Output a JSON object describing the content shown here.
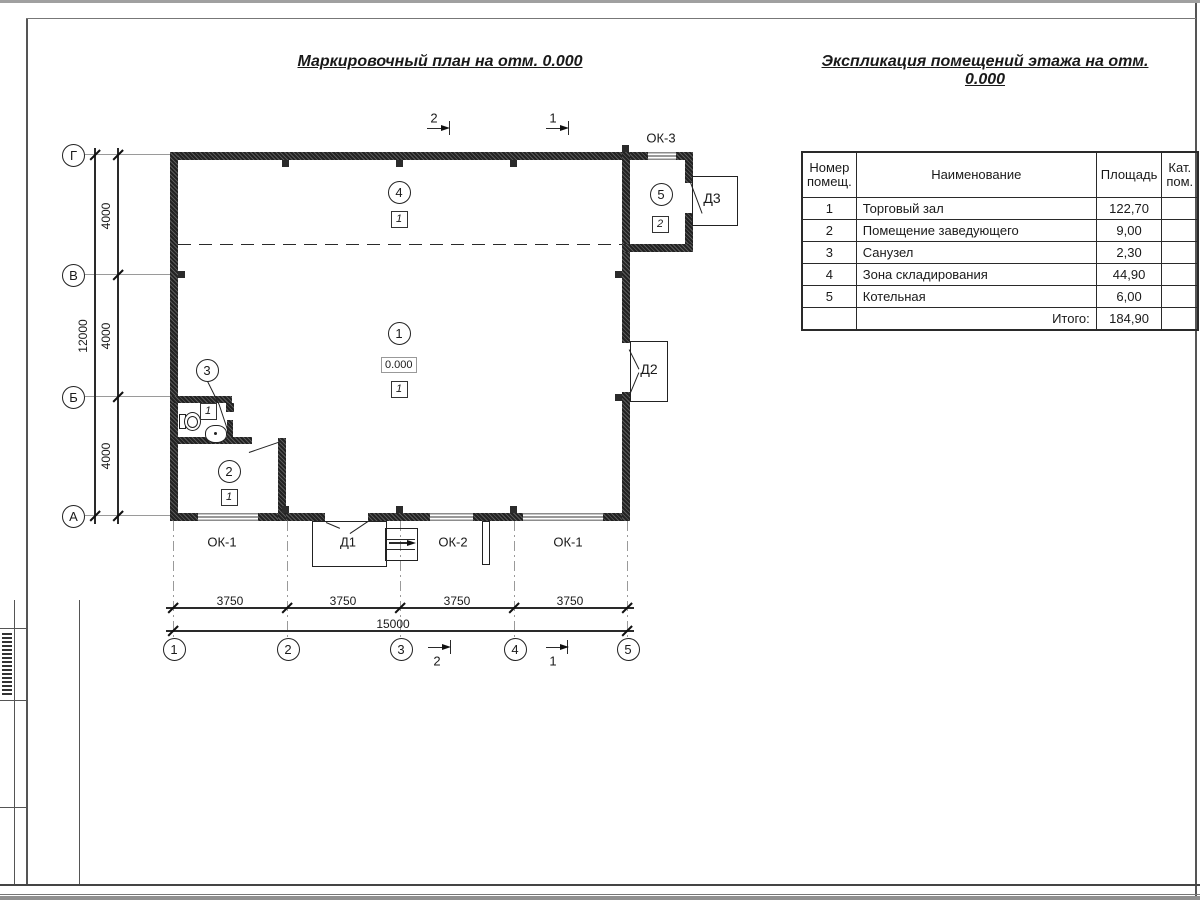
{
  "titles": {
    "plan": "Маркировочный план на отм. 0.000",
    "schedule": "Экспликация помещений этажа на отм. 0.000"
  },
  "schedule_table": {
    "header": {
      "col1a": "Номер",
      "col1b": "помещ.",
      "col2": "Наименование",
      "col3": "Площадь",
      "col4a": "Кат.",
      "col4b": "пом."
    },
    "rows": [
      {
        "num": "1",
        "name": "Торговый зал",
        "area": "122,70",
        "cat": ""
      },
      {
        "num": "2",
        "name": "Помещение заведующего",
        "area": "9,00",
        "cat": ""
      },
      {
        "num": "3",
        "name": "Санузел",
        "area": "2,30",
        "cat": ""
      },
      {
        "num": "4",
        "name": "Зона складирования",
        "area": "44,90",
        "cat": ""
      },
      {
        "num": "5",
        "name": "Котельная",
        "area": "6,00",
        "cat": ""
      }
    ],
    "total_label": "Итого:",
    "total_value": "184,90"
  },
  "plan": {
    "level_mark": "0.000",
    "axes_vertical": [
      "Г",
      "В",
      "Б",
      "А"
    ],
    "axes_horizontal": [
      "1",
      "2",
      "3",
      "4",
      "5"
    ],
    "dims_vertical": [
      "4000",
      "4000",
      "4000"
    ],
    "dim_vertical_total": "12000",
    "dims_horizontal": [
      "3750",
      "3750",
      "3750",
      "3750"
    ],
    "dim_horizontal_total": "15000",
    "rooms": [
      {
        "number": "1",
        "category": "1"
      },
      {
        "number": "2",
        "category": "1"
      },
      {
        "number": "3",
        "category": "1"
      },
      {
        "number": "4",
        "category": "1"
      },
      {
        "number": "5",
        "category": "2"
      }
    ],
    "openings": {
      "ok1": "ОК-1",
      "ok2": "ОК-2",
      "ok3": "ОК-3",
      "d1": "Д1",
      "d2": "Д2",
      "d3": "Д3"
    },
    "section_marks": {
      "one": "1",
      "two": "2"
    }
  }
}
